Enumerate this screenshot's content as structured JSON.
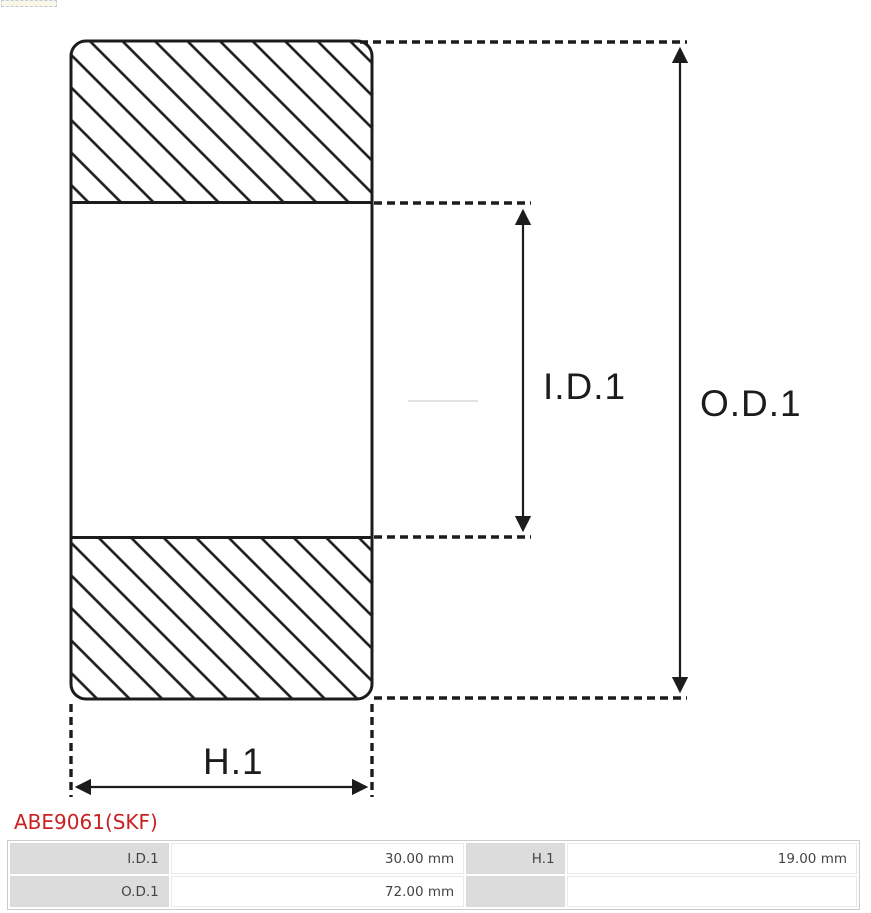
{
  "part": {
    "title": "ABE9061(SKF)"
  },
  "diagram": {
    "type": "bearing-cross-section",
    "id_label": "I.D.1",
    "od_label": "O.D.1",
    "h_label": "H.1"
  },
  "spec_table": {
    "rows": [
      [
        "I.D.1",
        "30.00 mm",
        "H.1",
        "19.00 mm"
      ],
      [
        "O.D.1",
        "72.00 mm",
        "",
        ""
      ]
    ]
  },
  "colors": {
    "line_black": "#1c1c1c",
    "accent_red": "#c92121",
    "cell_gray": "#dcdcdc",
    "table_border_gray": "#cccccc",
    "faint_line_gray": "#e3e3e3"
  }
}
